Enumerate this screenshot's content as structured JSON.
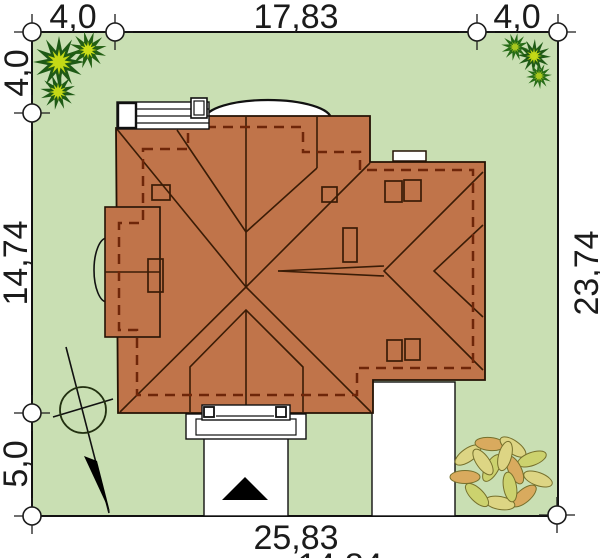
{
  "plan": {
    "dimensions": {
      "top": [
        "4,0",
        "17,83",
        "4,0"
      ],
      "left": [
        "4,0",
        "14,74",
        "5,0"
      ],
      "right": [
        "23,74"
      ],
      "bottom": [
        "25,83"
      ],
      "bottom_partial": "14,84"
    },
    "colors": {
      "grass": "#c9dfb3",
      "roof": "#c0744a",
      "roof_line": "#3a1c06",
      "roof_dash": "#6e2609",
      "paving": "#ffffff",
      "tree_dark": "#1e5a15",
      "tree_mid": "#2e7a1c",
      "tree_light": "#c4d916",
      "bush_leaf": "#ddd584",
      "bush_leaf_alt": "#d9aa5e",
      "bush_leaf_third": "#ccd26e",
      "text": "#1b1b1b"
    }
  }
}
